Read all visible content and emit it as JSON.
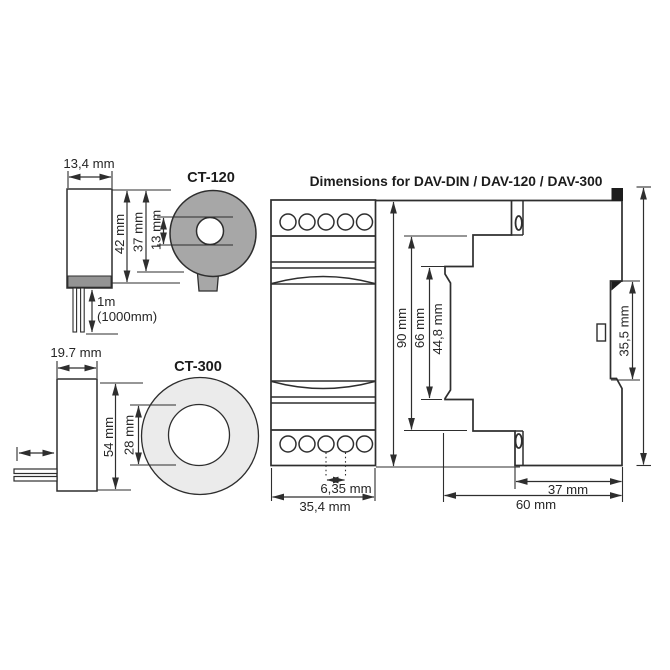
{
  "colors": {
    "line": "#2e2e2e",
    "ct120_body": "#a7a7a7",
    "ct120_cap": "#949494",
    "ct300_body": "#ebebeb",
    "clip_black": "#1d1d1d",
    "white": "#ffffff"
  },
  "ct120": {
    "label": "CT-120",
    "body_width": "13,4 mm",
    "body_height": "42 mm",
    "ring_od": "37 mm",
    "ring_id": "13 mm",
    "cable_length_line1": "1m",
    "cable_length_line2": "(1000mm)"
  },
  "ct300": {
    "label": "CT-300",
    "body_width": "19.7 mm",
    "ring_od": "54 mm",
    "ring_id": "28 mm"
  },
  "din_module": {
    "title": "Dimensions for DAV-DIN / DAV-120 / DAV-300",
    "front_view": {
      "overall_width": "35,4 mm",
      "terminal_pitch": "6,35 mm"
    },
    "heights": {
      "overall": "90 mm",
      "body": "66 mm",
      "center_section": "44,8 mm"
    },
    "side_view": {
      "overall_depth": "60 mm",
      "rear_depth": "37 mm",
      "din_clip_height": "35,5 mm"
    }
  }
}
